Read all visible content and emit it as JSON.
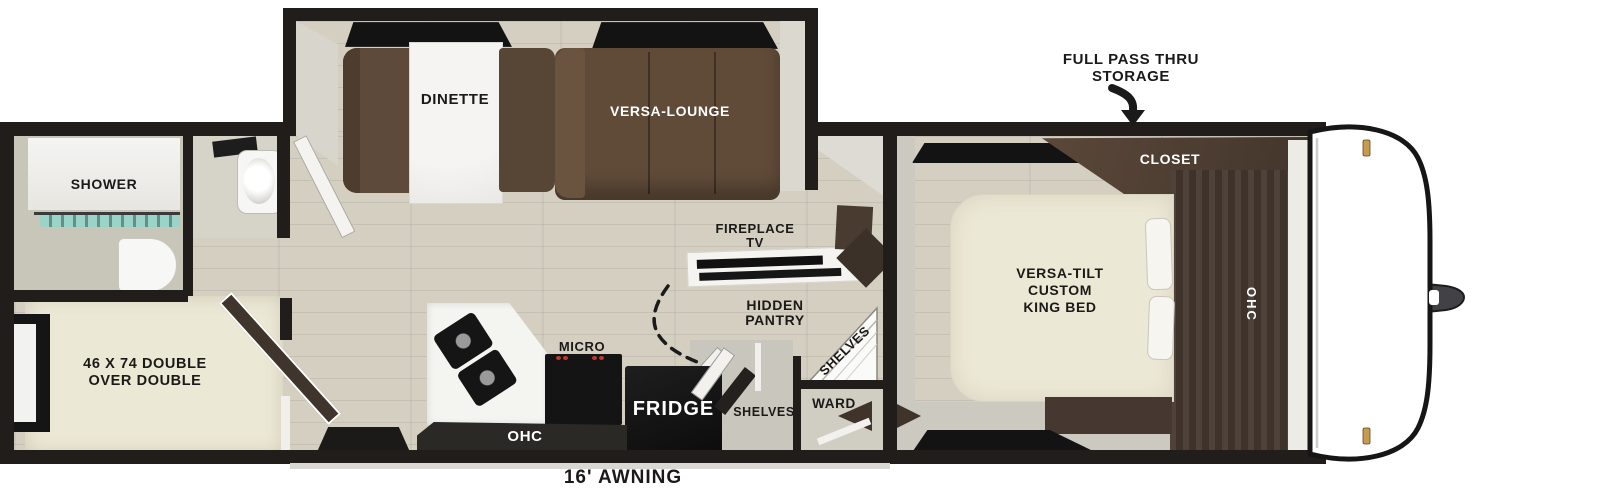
{
  "labels": {
    "full_pass_thru_line1": "FULL PASS THRU",
    "full_pass_thru_line2": "STORAGE",
    "dinette": "DINETTE",
    "versa_lounge": "VERSA-LOUNGE",
    "closet": "CLOSET",
    "shower": "SHOWER",
    "fireplace_line1": "FIREPLACE",
    "fireplace_line2": "TV",
    "hidden_pantry_line1": "HIDDEN",
    "hidden_pantry_line2": "PANTRY",
    "shelves_corner": "SHELVES",
    "shelves_hall": "SHELVES",
    "ward": "WARD",
    "king_bed_line1": "VERSA-TILT",
    "king_bed_line2": "CUSTOM",
    "king_bed_line3": "KING BED",
    "ohc_bedroom": "OHC",
    "ohc_kitchen": "OHC",
    "micro": "MICRO",
    "fridge": "FRIDGE",
    "bunk_line1": "46 X 74 DOUBLE",
    "bunk_line2": "OVER DOUBLE",
    "awning": "16' AWNING"
  },
  "colors": {
    "wall": "#201d1a",
    "floor_wood": "#d4cfc1",
    "sofa_brown": "#5d4a3a",
    "cabinet_brown": "#463830",
    "bed_cream": "#ece8d6",
    "appliance_black": "#131313",
    "shower_glass_teal": "#8fd8cc",
    "cap_clip_gold": "#c79b4e",
    "background": "#ffffff"
  }
}
